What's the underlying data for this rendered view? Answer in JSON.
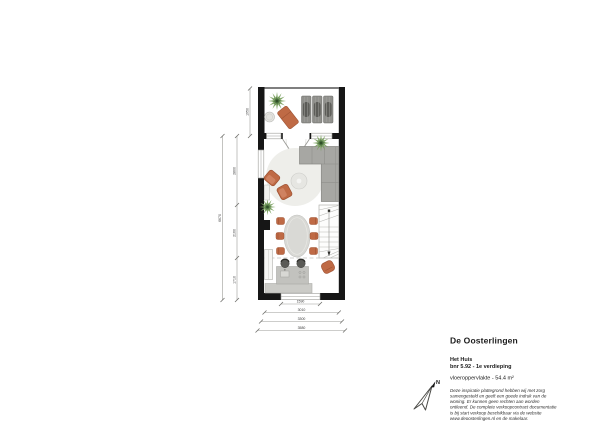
{
  "document": {
    "type": "floor-plan",
    "background": "#ffffff"
  },
  "title_block": {
    "project_title": "De Oosterlingen",
    "unit_name": "Het Huis",
    "unit_subtitle": "bnr 5.92 - 1e verdieping",
    "area_line": "vloeroppervlakte -  54.4 m²",
    "disclaimer": "Deze inspiratie plattegrond hebben wij met zorg samengesteld en geeft een goede indruk van de woning. Er kunnen geen rechten aan worden ontleend. De complete verkoopcontract documentatie is bij start verkoop beschikbaar via de website www.deoosterlingen.nl en de makelaar."
  },
  "compass": {
    "north_label": "N"
  },
  "dimensions": {
    "bottom_window": "1590",
    "bottom_inner": "3010",
    "bottom_mid": "3300",
    "bottom_outer": "3580",
    "balcony_depth": "1950",
    "left_total": "6670",
    "left_seg_top": "2800",
    "left_seg_mid": "2160",
    "left_seg_bottom": "1710"
  },
  "plan": {
    "furniture_icons": [
      "plant",
      "side-table",
      "lounge-chair",
      "sun-lounger",
      "corner-sofa",
      "round-rug",
      "coffee-table",
      "armchair",
      "dining-table",
      "dining-chair",
      "staircase",
      "kitchen-island",
      "bar-stool",
      "kitchen-counter",
      "tall-cabinet",
      "level-dashed-line"
    ],
    "colors": {
      "wall": "#161616",
      "terracotta": "#bf6a45",
      "sofa_gray": "#a7a7a3",
      "plant_green": "#6f9a58",
      "rug_gray": "#eeeeea",
      "dimension_gray": "#9b9b97"
    }
  }
}
